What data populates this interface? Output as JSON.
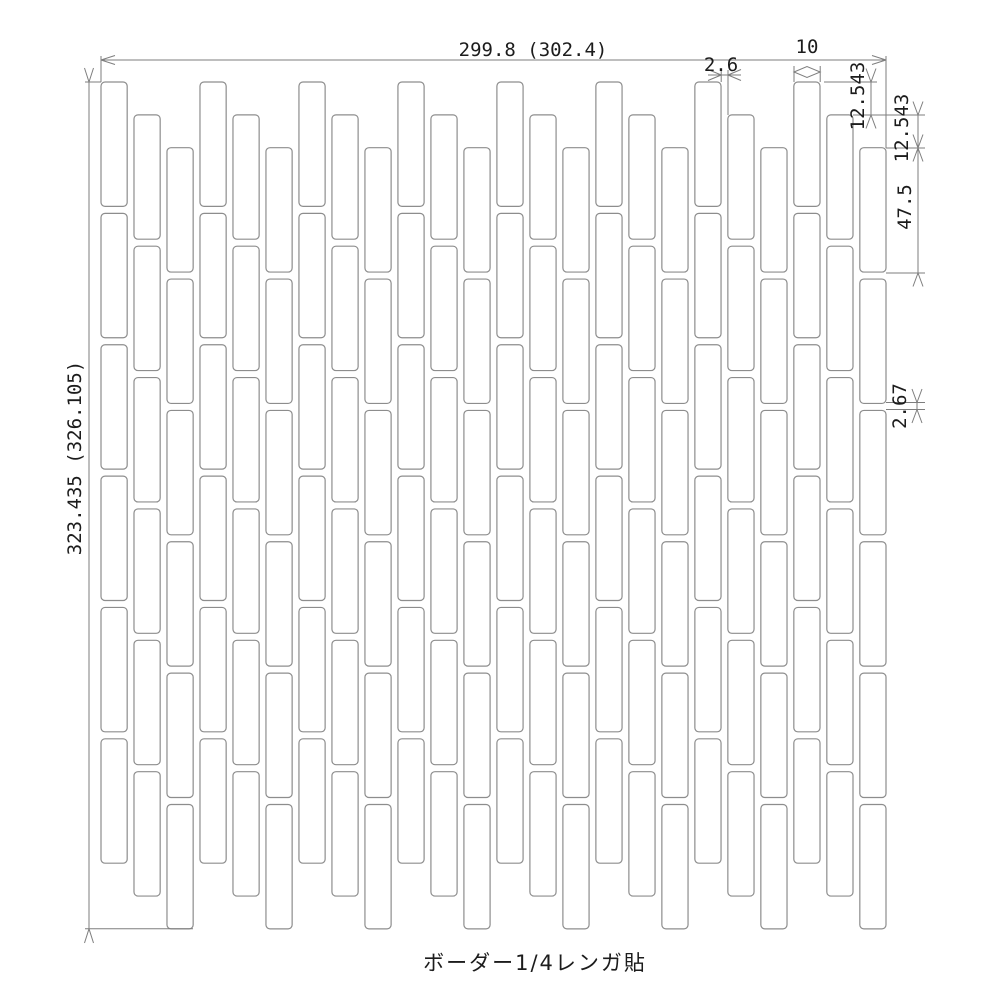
{
  "caption": {
    "label": "ボーダー1/4レンガ貼"
  },
  "dimensions": {
    "overall_width": {
      "label": "299.8 (302.4)"
    },
    "overall_height": {
      "label": "323.435 (326.105)"
    },
    "joint_width": {
      "label": "2.6"
    },
    "tile_width": {
      "label": "10"
    },
    "step_offset_1": {
      "label": "12.543"
    },
    "step_offset_2": {
      "label": "12.543"
    },
    "tile_height": {
      "label": "47.5"
    },
    "joint_height": {
      "label": "2.67"
    }
  },
  "pattern": {
    "type": "border-quarter-brick-bond",
    "columns": 24,
    "tiles_per_column": 6,
    "column_offset_cycle": [
      0,
      1,
      2
    ],
    "unit": {
      "tile_w": 10,
      "tile_h": 47.5,
      "joint_w": 2.6,
      "joint_h": 2.67,
      "step": 12.543,
      "overall_w": 299.8,
      "overall_w_with_joint": 302.4,
      "overall_h": 323.435,
      "overall_h_with_joint": 326.105
    }
  },
  "colors": {
    "line": "#7e7e7e",
    "tile_line": "#8d8d8d",
    "text": "#1c1c1c",
    "background": "#ffffff"
  }
}
